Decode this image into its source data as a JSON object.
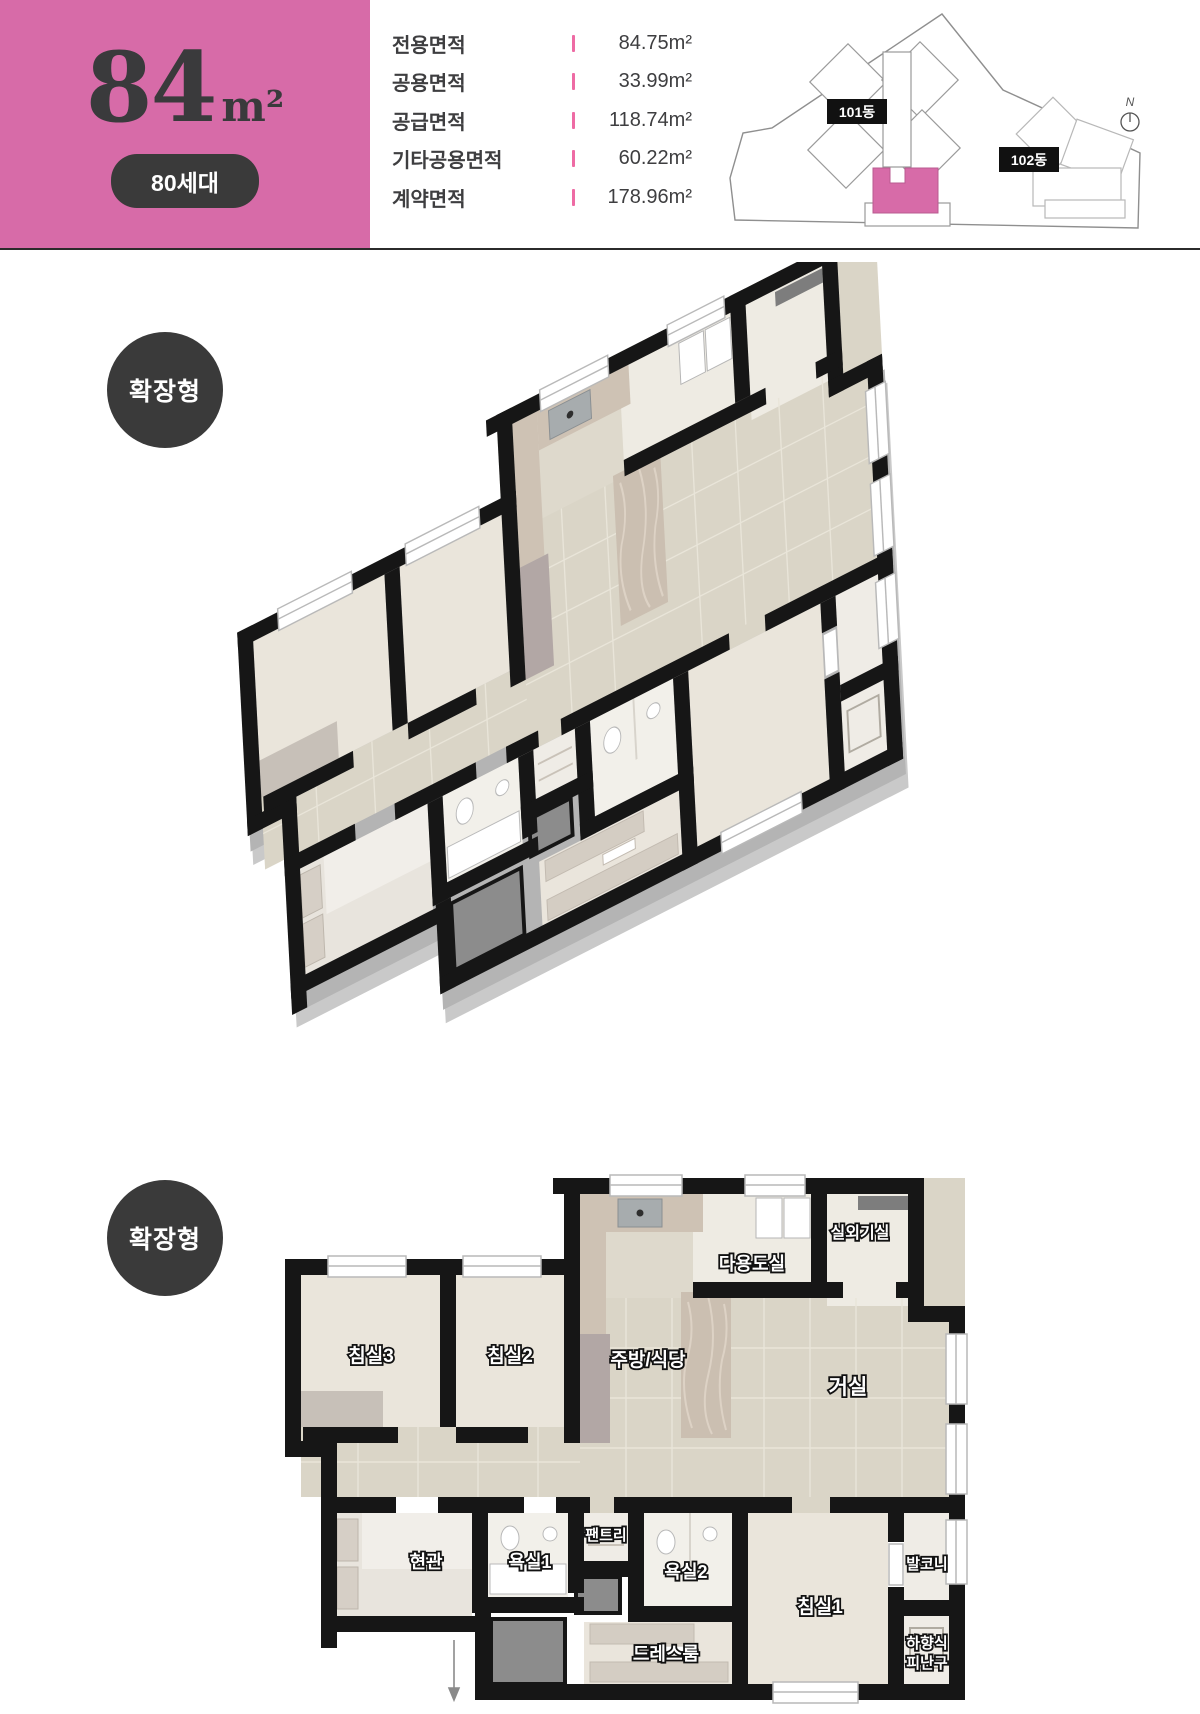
{
  "header": {
    "size_number": "84",
    "size_unit": "m²",
    "households": "80세대",
    "area_rows": [
      {
        "label": "전용면적",
        "value": "84.75m²"
      },
      {
        "label": "공용면적",
        "value": "33.99m²"
      },
      {
        "label": "공급면적",
        "value": "118.74m²"
      },
      {
        "label": "기타공용면적",
        "value": "60.22m²"
      },
      {
        "label": "계약면적",
        "value": "178.96m²"
      }
    ],
    "site": {
      "b101": "101동",
      "b102": "102동",
      "north": "N"
    }
  },
  "badges": {
    "iso": "확장형",
    "flat": "확장형"
  },
  "rooms": {
    "bedroom3": "침실3",
    "bedroom2": "침실2",
    "kitchen": "주방/식당",
    "utility": "다용도실",
    "outdoor_unit": "실외기실",
    "living": "거실",
    "entrance": "현관",
    "bath1": "욕실1",
    "pantry": "팬트리",
    "bath2": "욕실2",
    "bedroom1": "침실1",
    "balcony": "발코니",
    "dressroom": "드레스룸",
    "escape_line1": "하향식",
    "escape_line2": "피난구"
  },
  "colors": {
    "accent_pink": "#d76ba8",
    "badge_dark": "#3a3a3a",
    "wall_black": "#161616"
  }
}
